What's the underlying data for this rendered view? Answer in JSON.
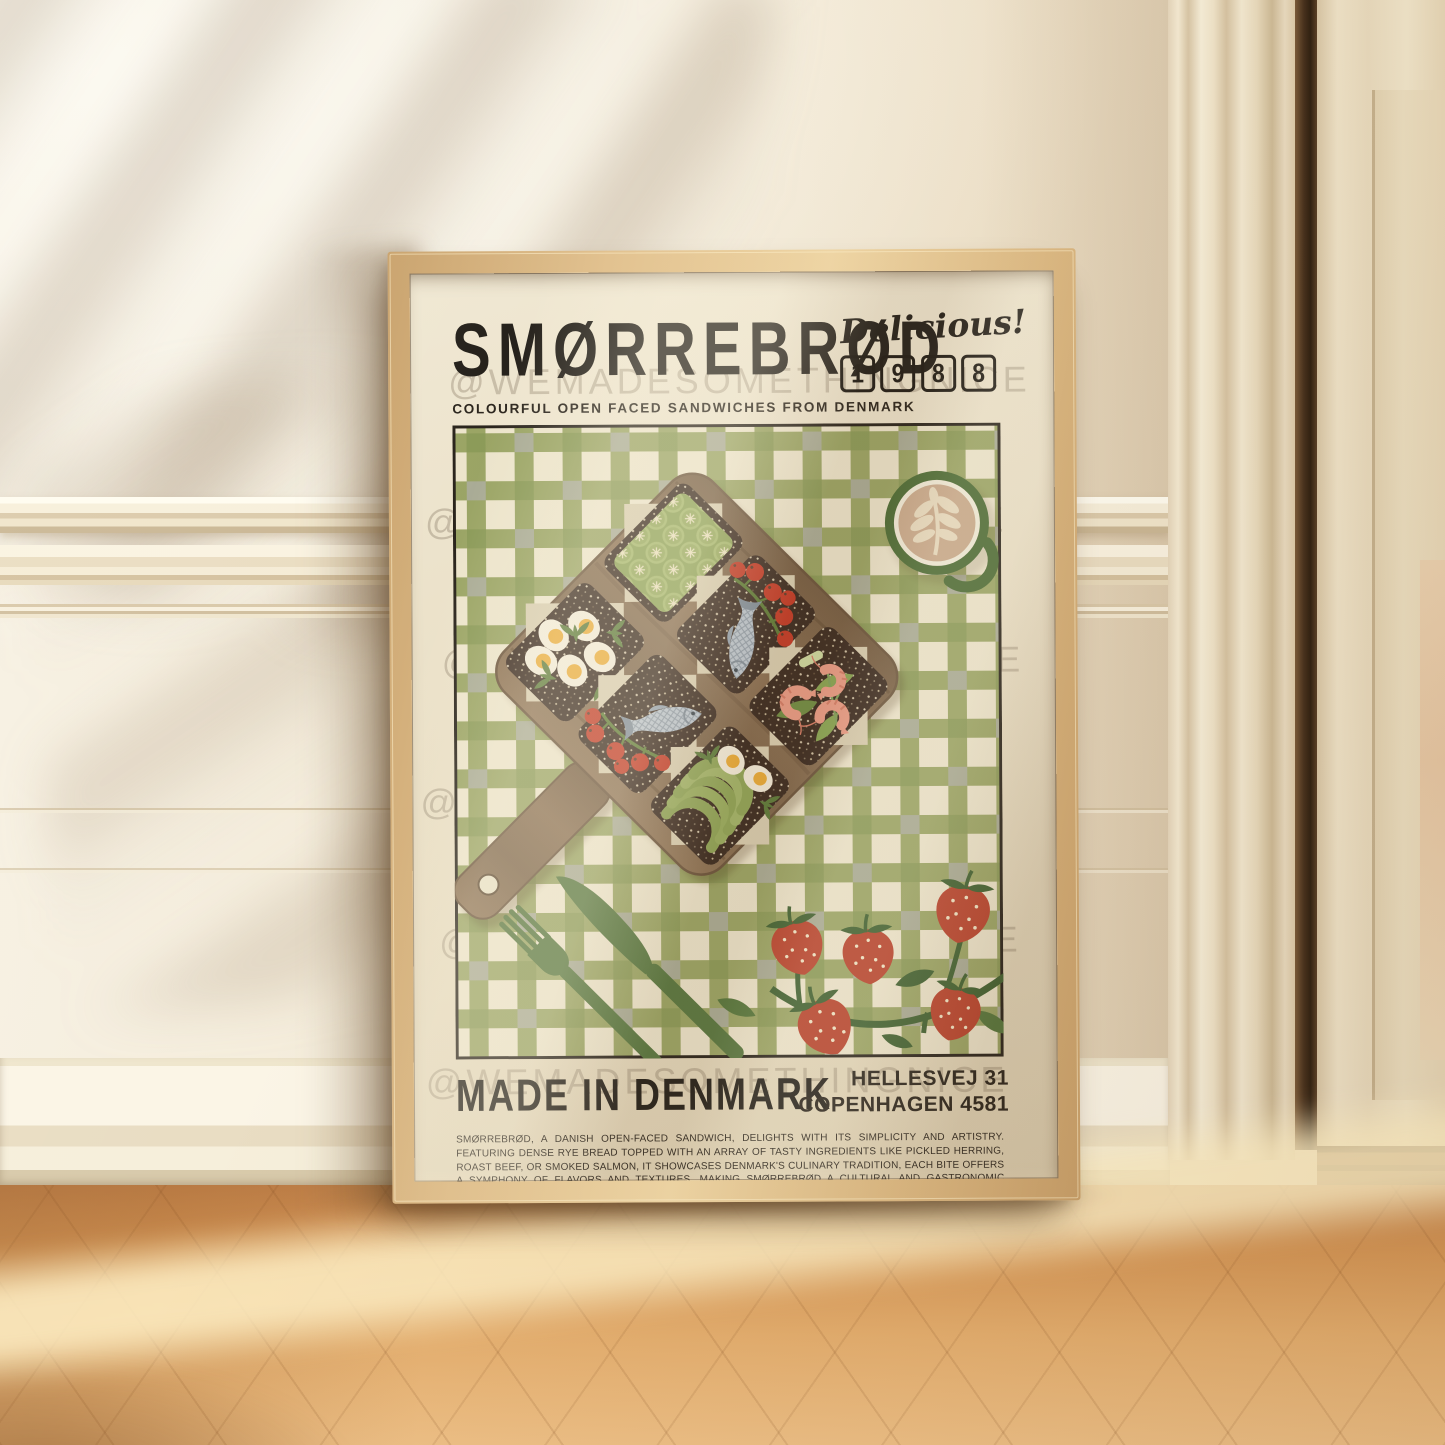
{
  "scene": {
    "description": "Framed Smørrebrød art print leaning against a panelled cream wall on a herringbone wood floor beside a door",
    "colors": {
      "wall": "#f4ecda",
      "floor_wood": "#dd9f63",
      "frame_wood": "#e2c290",
      "poster_cream": "#e8ddc3"
    }
  },
  "poster": {
    "title": "SMØRREBRØD",
    "tagline": "Delicious!",
    "year_digits": [
      "1",
      "9",
      "8",
      "8"
    ],
    "subtitle": "COLOURFUL OPEN FACED SANDWICHES FROM DENMARK",
    "made_in": "MADE IN DENMARK",
    "address_line1": "HELLESVEJ 31",
    "address_line2": "COPENHAGEN 4581",
    "description": "SMØRREBRØD, A DANISH OPEN-FACED SANDWICH, DELIGHTS WITH ITS SIMPLICITY AND ARTISTRY. FEATURING DENSE RYE BREAD TOPPED WITH AN ARRAY OF TASTY INGREDIENTS LIKE PICKLED HERRING, ROAST BEEF, OR SMOKED SALMON, IT SHOWCASES DENMARK'S CULINARY TRADITION, EACH BITE OFFERS A SYMPHONY OF FLAVORS AND TEXTURES, MAKING SMØRREBRØD A CULTURAL AND GASTRONOMIC TREASURE.",
    "watermark": "@WEMADESOMETHINGNICE",
    "illustration": {
      "tablecloth": "green gingham picnic cloth",
      "board": "wooden serving board with six rye smørrebrød",
      "sandwiches": [
        "egg and cress",
        "cucumber",
        "herring with tomato vine",
        "herring with tomato vine",
        "shrimp and greens",
        "avocado and egg"
      ],
      "sides": [
        "latte with leaf art",
        "strawberry vine",
        "green fork and knife"
      ],
      "colors": {
        "cream": "#ece4cb",
        "green": "#9aa464",
        "sage": "#a9ab95",
        "rye": "#3a2a20",
        "board_wood": "#86694c",
        "tomato_red": "#c23a26",
        "strawberry_red": "#b8422c",
        "shrimp_pink": "#e99b85",
        "cutlery_green": "#57763f",
        "cup_green": "#4a6a33"
      }
    }
  }
}
